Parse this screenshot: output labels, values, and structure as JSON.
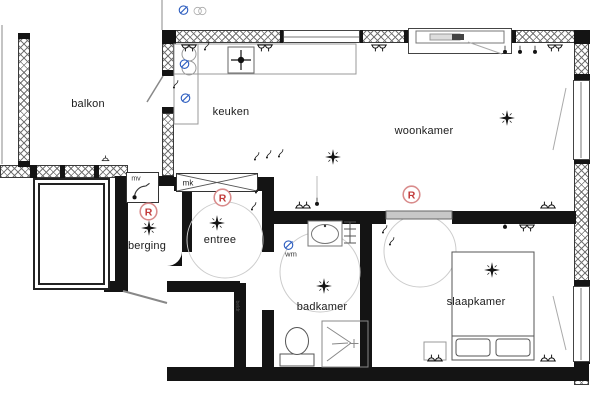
{
  "rooms": [
    {
      "id": "balkon",
      "label": "balkon"
    },
    {
      "id": "keuken",
      "label": "keuken"
    },
    {
      "id": "woonkamer",
      "label": "woonkamer"
    },
    {
      "id": "berging",
      "label": "berging"
    },
    {
      "id": "entree",
      "label": "entree"
    },
    {
      "id": "badkamer",
      "label": "badkamer"
    },
    {
      "id": "slaapkamer",
      "label": "slaapkamer"
    }
  ],
  "small_labels": [
    {
      "id": "mv",
      "label": "mv"
    },
    {
      "id": "mk",
      "label": "mk"
    },
    {
      "id": "wm",
      "label": "wm"
    },
    {
      "id": "beldr",
      "label": "beldr"
    }
  ],
  "symbols": [
    {
      "type": "ceiling-light",
      "x": 333,
      "y": 157,
      "s": 20
    },
    {
      "type": "ceiling-light",
      "x": 507,
      "y": 118,
      "s": 20
    },
    {
      "type": "ceiling-light",
      "x": 149,
      "y": 228,
      "s": 20
    },
    {
      "type": "ceiling-light",
      "x": 217,
      "y": 223,
      "s": 20
    },
    {
      "type": "ceiling-light",
      "x": 324,
      "y": 286,
      "s": 20
    },
    {
      "type": "ceiling-light",
      "x": 492,
      "y": 270,
      "s": 20
    },
    {
      "type": "smoke-detector",
      "x": 148,
      "y": 211,
      "s": 21
    },
    {
      "type": "smoke-detector",
      "x": 222,
      "y": 197,
      "s": 21
    },
    {
      "type": "smoke-detector",
      "x": 411,
      "y": 194,
      "s": 21
    },
    {
      "type": "socket-double",
      "x": 189,
      "y": 48,
      "s": 18,
      "r": 180
    },
    {
      "type": "socket-double",
      "x": 265,
      "y": 48,
      "s": 18,
      "r": 180
    },
    {
      "type": "socket-double",
      "x": 379,
      "y": 48,
      "s": 18,
      "r": 180
    },
    {
      "type": "socket-double",
      "x": 555,
      "y": 48,
      "s": 18,
      "r": 180
    },
    {
      "type": "socket-double",
      "x": 527,
      "y": 228,
      "s": 18,
      "r": 180
    },
    {
      "type": "socket-double",
      "x": 303,
      "y": 205,
      "s": 18
    },
    {
      "type": "socket-double",
      "x": 548,
      "y": 205,
      "s": 18
    },
    {
      "type": "socket-double",
      "x": 435,
      "y": 358,
      "s": 18
    },
    {
      "type": "socket-double",
      "x": 548,
      "y": 358,
      "s": 18
    },
    {
      "type": "socket-single",
      "x": 105,
      "y": 158,
      "s": 13
    },
    {
      "type": "spotlight",
      "x": 505,
      "y": 51,
      "s": 14
    },
    {
      "type": "spotlight",
      "x": 520,
      "y": 51,
      "s": 14
    },
    {
      "type": "spotlight",
      "x": 535,
      "y": 51,
      "s": 14
    },
    {
      "type": "spotlight",
      "x": 505,
      "y": 226,
      "s": 14
    },
    {
      "type": "spotlight",
      "x": 317,
      "y": 203,
      "s": 14
    },
    {
      "type": "switch-hook",
      "x": 207,
      "y": 46,
      "s": 14
    },
    {
      "type": "switch-hook",
      "x": 176,
      "y": 84,
      "s": 14
    },
    {
      "type": "switch-hook",
      "x": 258,
      "y": 189,
      "s": 14
    },
    {
      "type": "switch-hook",
      "x": 254,
      "y": 206,
      "s": 14
    },
    {
      "type": "switch-hook",
      "x": 385,
      "y": 229,
      "s": 14
    },
    {
      "type": "switch-hook",
      "x": 392,
      "y": 241,
      "s": 14
    },
    {
      "type": "switch-hook",
      "x": 257,
      "y": 156,
      "s": 14
    },
    {
      "type": "switch-hook",
      "x": 269,
      "y": 154,
      "s": 14
    },
    {
      "type": "switch-hook",
      "x": 281,
      "y": 153,
      "s": 14
    },
    {
      "type": "water-point",
      "x": 184,
      "y": 63,
      "s": 15
    },
    {
      "type": "water-point",
      "x": 185,
      "y": 97,
      "s": 15
    },
    {
      "type": "water-point",
      "x": 288,
      "y": 244,
      "s": 15
    },
    {
      "type": "water-point",
      "x": 183,
      "y": 9,
      "s": 15
    },
    {
      "type": "gray-circles",
      "x": 200,
      "y": 11,
      "s": 16
    },
    {
      "type": "bell",
      "x": 241,
      "y": 290,
      "s": 9
    }
  ],
  "colors": {
    "wall": "#141414",
    "hatch_line": "#8f8f8f",
    "linework": "#666666",
    "accent_red": "#c23b3b",
    "accent_blue": "#2f5fc0",
    "door_gray": "#c8c8c8",
    "background": "#ffffff"
  }
}
